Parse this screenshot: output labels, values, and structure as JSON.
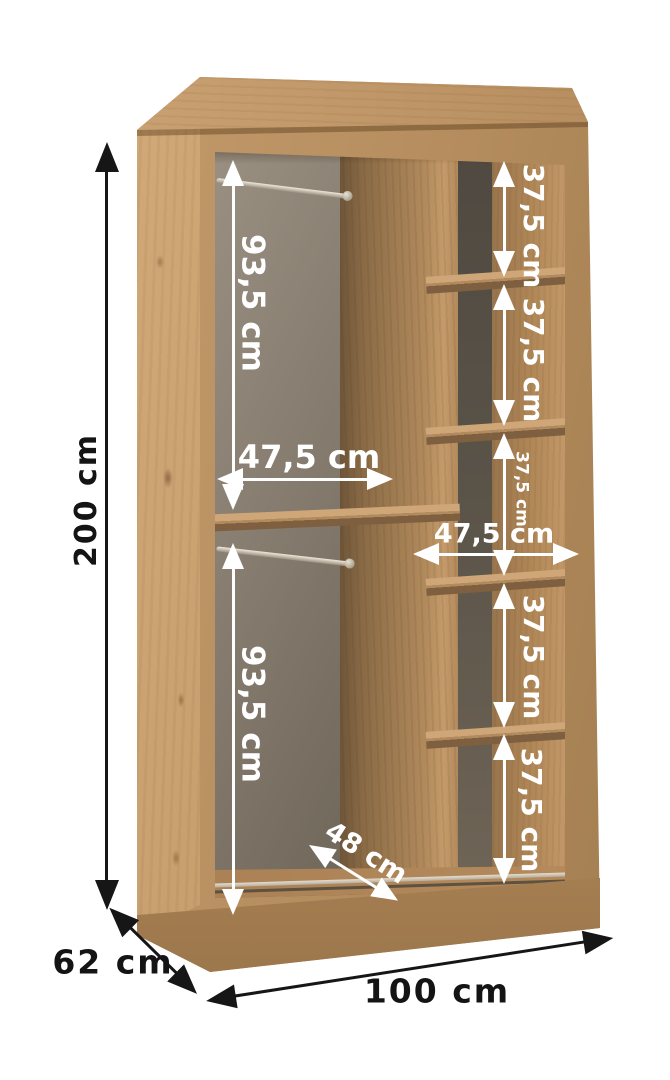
{
  "dimensions": {
    "overall": {
      "height": "200 cm",
      "depth": "62 cm",
      "width": "100 cm"
    },
    "left_column": {
      "top_section_height": "93,5 cm",
      "bottom_section_height": "93,5 cm",
      "column_width": "47,5 cm",
      "floor_depth": "48 cm"
    },
    "right_column": {
      "column_width": "47,5 cm",
      "section_heights": [
        "37,5 cm",
        "37,5 cm",
        "37,5 cm",
        "37,5 cm",
        "37,5 cm"
      ]
    }
  },
  "colors": {
    "background": "#ffffff",
    "outer_arrow": "#161616",
    "inner_arrow": "#ffffff",
    "wood_light": "#d6ae7e",
    "wood_mid": "#b58d5e",
    "wood_dark": "#6f5639",
    "back_panel_left": "#877d70",
    "back_panel_right": "#4f4941"
  }
}
